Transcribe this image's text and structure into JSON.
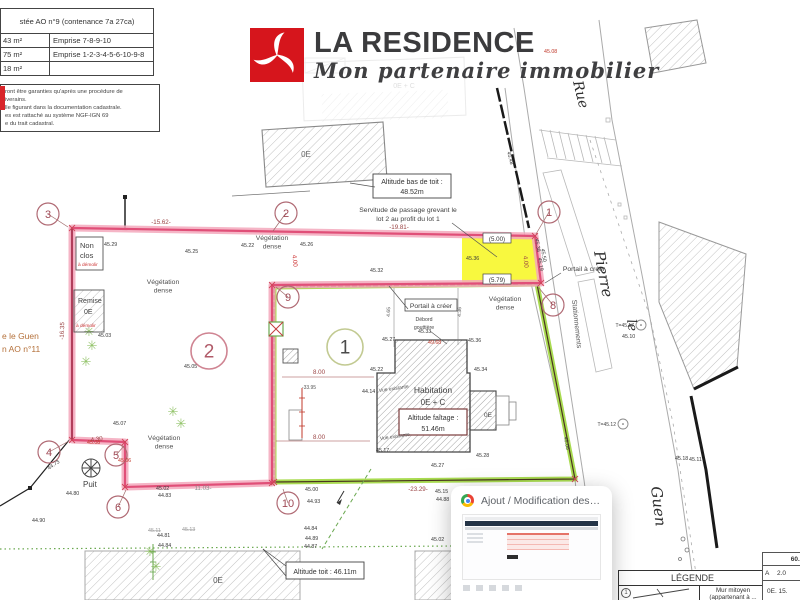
{
  "parcel_table": {
    "title": "stée AO n°9 (contenance 7a 27ca)",
    "rows": [
      {
        "left": "43 m²",
        "right": "Emprise 7-8-9-10"
      },
      {
        "left": "75 m²",
        "right": "Emprise 1-2-3-4-5-6-10-9-8"
      },
      {
        "left": "18 m²",
        "right": ""
      }
    ]
  },
  "note_box": {
    "lines": [
      "ront être garanties qu'après une procédure de",
      "iverains.",
      "lle figurant dans la documentation cadastrale.",
      "es est rattaché au système NGF-IGN 69",
      "e du trait cadastral."
    ]
  },
  "logo": {
    "name": "LA RESIDENCE",
    "tagline": "Mon partenaire immobilier",
    "brand_red": "#d6151c",
    "mark_icon": "triskelion-icon"
  },
  "plan": {
    "labels": {
      "rue": "Rue",
      "pierre": "Pierre",
      "le": "le",
      "guen": "Guen",
      "stationnements": "Stationnements",
      "street_left1": "e le Guen",
      "street_left2": "n AO n°11",
      "non_clos1": "Non",
      "non_clos2": "clos",
      "a_demolir": "à démolir",
      "remise": "Remise",
      "oe": "0E",
      "oe_c_ghost": "0E + C",
      "habitation": "Habitation",
      "habitation_lvl": "0E + C",
      "faitage1": "Altitude faîtage :",
      "faitage2": "51.46m",
      "bas_toit1": "Altitude bas de toit :",
      "bas_toit2": "48.52m",
      "alt_toit": "Altitude toit : 46.11m",
      "servitude1": "Servitude de passage grevant le",
      "servitude2": "lot 2 au profit du lot 1",
      "portail": "Portail à créer",
      "debord1": "Débord",
      "debord2": "gouttière",
      "vue": "Vue existante",
      "puit": "Puit"
    },
    "veg_line1": "Végétation",
    "veg_line2": "dense",
    "veg_labels": [
      {
        "x": 272,
        "y": 240
      },
      {
        "x": 163,
        "y": 284
      },
      {
        "x": 505,
        "y": 301
      },
      {
        "x": 164,
        "y": 440
      }
    ],
    "markers": [
      {
        "n": "1",
        "x": 549,
        "y": 212,
        "lx": 536,
        "ly": 234
      },
      {
        "n": "2",
        "x": 286,
        "y": 213,
        "lx": 273,
        "ly": 231
      },
      {
        "n": "3",
        "x": 48,
        "y": 214,
        "lx": 68,
        "ly": 227
      },
      {
        "n": "4",
        "x": 49,
        "y": 452,
        "lx": 69,
        "ly": 441
      },
      {
        "n": "5",
        "x": 116,
        "y": 455,
        "lx": 124,
        "ly": 446
      },
      {
        "n": "6",
        "x": 118,
        "y": 507,
        "lx": 126,
        "ly": 490
      },
      {
        "n": "8",
        "x": 553,
        "y": 305,
        "lx": 539,
        "ly": 288
      },
      {
        "n": "9",
        "x": 288,
        "y": 297,
        "lx": 276,
        "ly": 287
      },
      {
        "n": "10",
        "x": 288,
        "y": 503,
        "lx": 283,
        "ly": 489
      }
    ],
    "lots": [
      {
        "n": "2",
        "x": 209,
        "y": 351
      },
      {
        "n": "1",
        "x": 345,
        "y": 347
      }
    ],
    "trees": [
      {
        "t": "T=45.17",
        "x": 641,
        "y": 325
      },
      {
        "t": "T=45.12",
        "x": 623,
        "y": 424
      }
    ],
    "dims": [
      {
        "t": "-15.62-",
        "x": 161,
        "y": 224
      },
      {
        "t": "-19.81-",
        "x": 399,
        "y": 229
      },
      {
        "t": "(5.00)",
        "x": 497,
        "y": 241,
        "box": true,
        "c": "dark"
      },
      {
        "t": "4.00",
        "x": 524,
        "y": 262,
        "r": 85
      },
      {
        "t": "(5.79)",
        "x": 497,
        "y": 282,
        "box": true,
        "c": "dark"
      },
      {
        "t": "4.00",
        "x": 293,
        "y": 261,
        "r": 85,
        "c": "red"
      },
      {
        "t": "-16.35",
        "x": 64,
        "y": 331,
        "r": -88
      },
      {
        "t": "4.30",
        "x": 97,
        "y": 441,
        "r": -8
      },
      {
        "t": "11.03-",
        "x": 203,
        "y": 490,
        "c": "gray"
      },
      {
        "t": "-23.29-",
        "x": 418,
        "y": 491
      },
      {
        "t": "8.00",
        "x": 319,
        "y": 374
      },
      {
        "t": "8.00",
        "x": 319,
        "y": 439
      },
      {
        "t": "-33.95",
        "x": 309,
        "y": 389,
        "c": "small"
      },
      {
        "t": "4.65",
        "x": 390,
        "y": 312,
        "r": -88,
        "c": "small"
      },
      {
        "t": "4.36",
        "x": 461,
        "y": 312,
        "r": -88,
        "c": "small"
      }
    ],
    "spots": [
      {
        "v": "45.29",
        "x": 104,
        "y": 246
      },
      {
        "v": "45.25",
        "x": 185,
        "y": 253
      },
      {
        "v": "45.22",
        "x": 241,
        "y": 247
      },
      {
        "v": "45.26",
        "x": 300,
        "y": 246
      },
      {
        "v": "45.32",
        "x": 370,
        "y": 272
      },
      {
        "v": "45.36",
        "x": 466,
        "y": 260
      },
      {
        "v": "45.03",
        "x": 98,
        "y": 337
      },
      {
        "v": "45.05",
        "x": 184,
        "y": 368
      },
      {
        "v": "45.07",
        "x": 113,
        "y": 425
      },
      {
        "v": "45.08",
        "x": 87,
        "y": 444,
        "c": "red"
      },
      {
        "v": "45.06",
        "x": 118,
        "y": 462,
        "c": "red"
      },
      {
        "v": "44.80",
        "x": 66,
        "y": 495
      },
      {
        "v": "44.90",
        "x": 32,
        "y": 522
      },
      {
        "v": "45.02",
        "x": 156,
        "y": 490
      },
      {
        "v": "44.83",
        "x": 158,
        "y": 497
      },
      {
        "v": "45.00",
        "x": 305,
        "y": 491
      },
      {
        "v": "44.93",
        "x": 307,
        "y": 503
      },
      {
        "v": "44.84",
        "x": 304,
        "y": 530
      },
      {
        "v": "44.89",
        "x": 305,
        "y": 540
      },
      {
        "v": "44.87",
        "x": 304,
        "y": 548
      },
      {
        "v": "45.15",
        "x": 435,
        "y": 493
      },
      {
        "v": "44.88",
        "x": 436,
        "y": 501
      },
      {
        "v": "45.02",
        "x": 431,
        "y": 541
      },
      {
        "v": "45.27",
        "x": 382,
        "y": 341
      },
      {
        "v": "45.33",
        "x": 418,
        "y": 333
      },
      {
        "v": "49.68",
        "x": 428,
        "y": 344,
        "c": "red"
      },
      {
        "v": "45.36",
        "x": 468,
        "y": 342
      },
      {
        "v": "45.22",
        "x": 370,
        "y": 371
      },
      {
        "v": "45.34",
        "x": 474,
        "y": 371
      },
      {
        "v": "44.14",
        "x": 362,
        "y": 393
      },
      {
        "v": "45.17",
        "x": 376,
        "y": 452
      },
      {
        "v": "45.28",
        "x": 476,
        "y": 457
      },
      {
        "v": "45.27",
        "x": 431,
        "y": 467
      },
      {
        "v": "45.38",
        "x": 535,
        "y": 239,
        "r": 80
      },
      {
        "v": "45.50",
        "x": 541,
        "y": 249,
        "r": 80
      },
      {
        "v": "45.19",
        "x": 538,
        "y": 258,
        "r": 80
      },
      {
        "v": "45.05",
        "x": 564,
        "y": 437,
        "r": 80
      },
      {
        "v": "45.48",
        "x": 507,
        "y": 152,
        "r": 75
      },
      {
        "v": "45.10",
        "x": 622,
        "y": 338
      },
      {
        "v": "45.18",
        "x": 675,
        "y": 460
      },
      {
        "v": "45.11",
        "x": 689,
        "y": 461
      },
      {
        "v": "45.08",
        "x": 544,
        "y": 53,
        "c": "red"
      },
      {
        "v": "45.11",
        "x": 148,
        "y": 532,
        "c": "strike"
      },
      {
        "v": "45.13",
        "x": 182,
        "y": 531,
        "c": "strike"
      },
      {
        "v": "44.81",
        "x": 157,
        "y": 537
      },
      {
        "v": "44.84",
        "x": 158,
        "y": 547
      },
      {
        "v": "44.73",
        "x": 49,
        "y": 470,
        "r": -35
      }
    ],
    "ticks": [
      [
        72,
        228
      ],
      [
        535,
        236
      ],
      [
        541,
        283
      ],
      [
        272,
        285
      ],
      [
        272,
        483
      ],
      [
        125,
        487
      ],
      [
        125,
        442
      ],
      [
        72,
        440
      ],
      [
        575,
        479
      ],
      [
        274,
        482
      ]
    ]
  },
  "popup": {
    "title": "Ajout / Modification des ph...",
    "icon": "chrome-icon"
  },
  "legend": {
    "title": "LÉGENDE",
    "item1_num": "1",
    "item1_line1": "Mur mitoyen",
    "item1_line2": "(appartenant à ..."
  },
  "corner_table": {
    "header": "60.50",
    "r1c1": "A",
    "r1c2": "2.0",
    "r2": "0E. 15."
  }
}
